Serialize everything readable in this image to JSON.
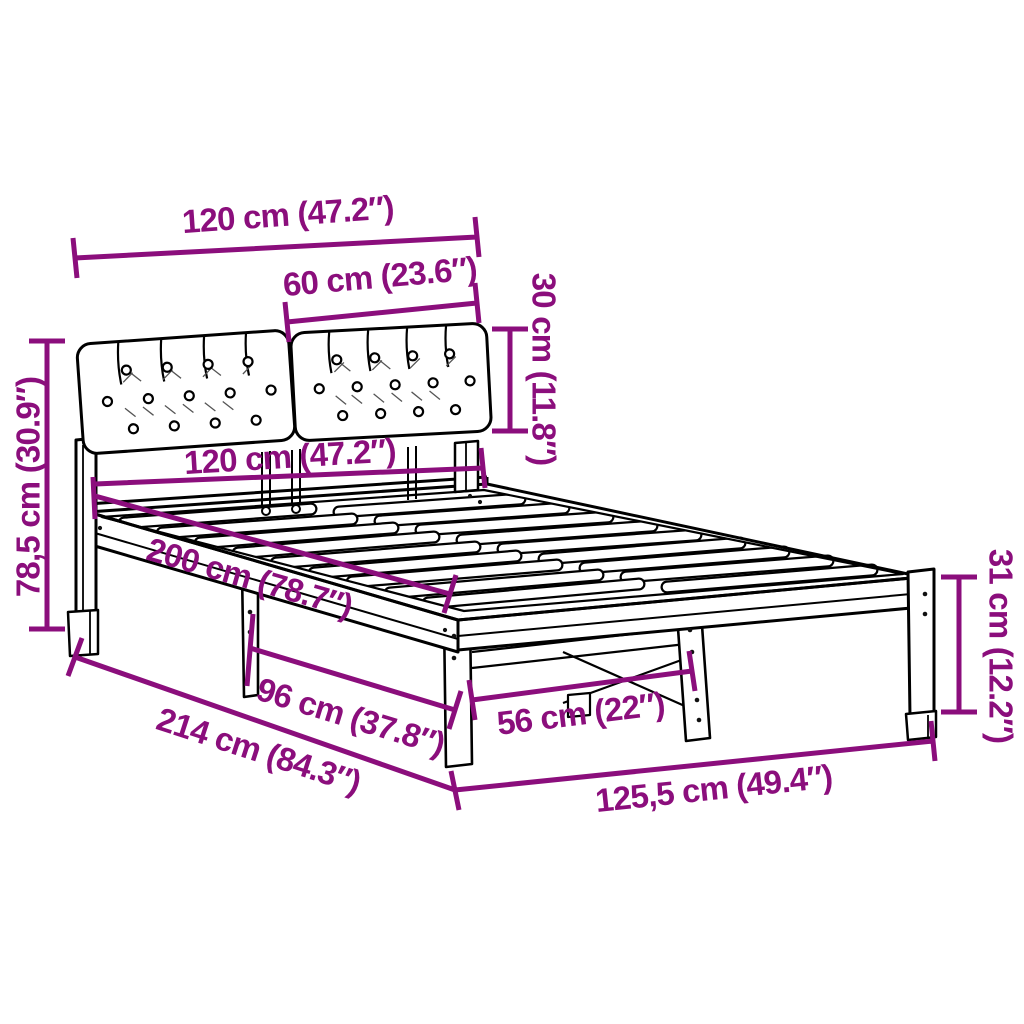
{
  "diagram": {
    "type": "product-dimension-diagram",
    "subject": "bed-frame-with-upholstered-headboard",
    "colors": {
      "dimension": "#8B0E7C",
      "outline": "#000000",
      "background": "#FFFFFF",
      "crease": "#555555",
      "screw": "#111111"
    },
    "dimensions": [
      {
        "id": "headboard-width",
        "label": "120 cm (47.2″)"
      },
      {
        "id": "cushion-width",
        "label": "60 cm (23.6″)"
      },
      {
        "id": "cushion-height",
        "label": "30 cm (11.8″)"
      },
      {
        "id": "headboard-height",
        "label": "78,5 cm (30.9″)"
      },
      {
        "id": "bed-width",
        "label": "120 cm (47.2″)"
      },
      {
        "id": "bed-length",
        "label": "200 cm (78.7″)"
      },
      {
        "id": "leg-spacing-length",
        "label": "96 cm (37.8″)"
      },
      {
        "id": "leg-spacing-width",
        "label": "56 cm (22″)"
      },
      {
        "id": "total-length",
        "label": "214 cm (84.3″)"
      },
      {
        "id": "total-width",
        "label": "125,5 cm (49.4″)"
      },
      {
        "id": "leg-height",
        "label": "31 cm (12.2″)"
      }
    ]
  }
}
